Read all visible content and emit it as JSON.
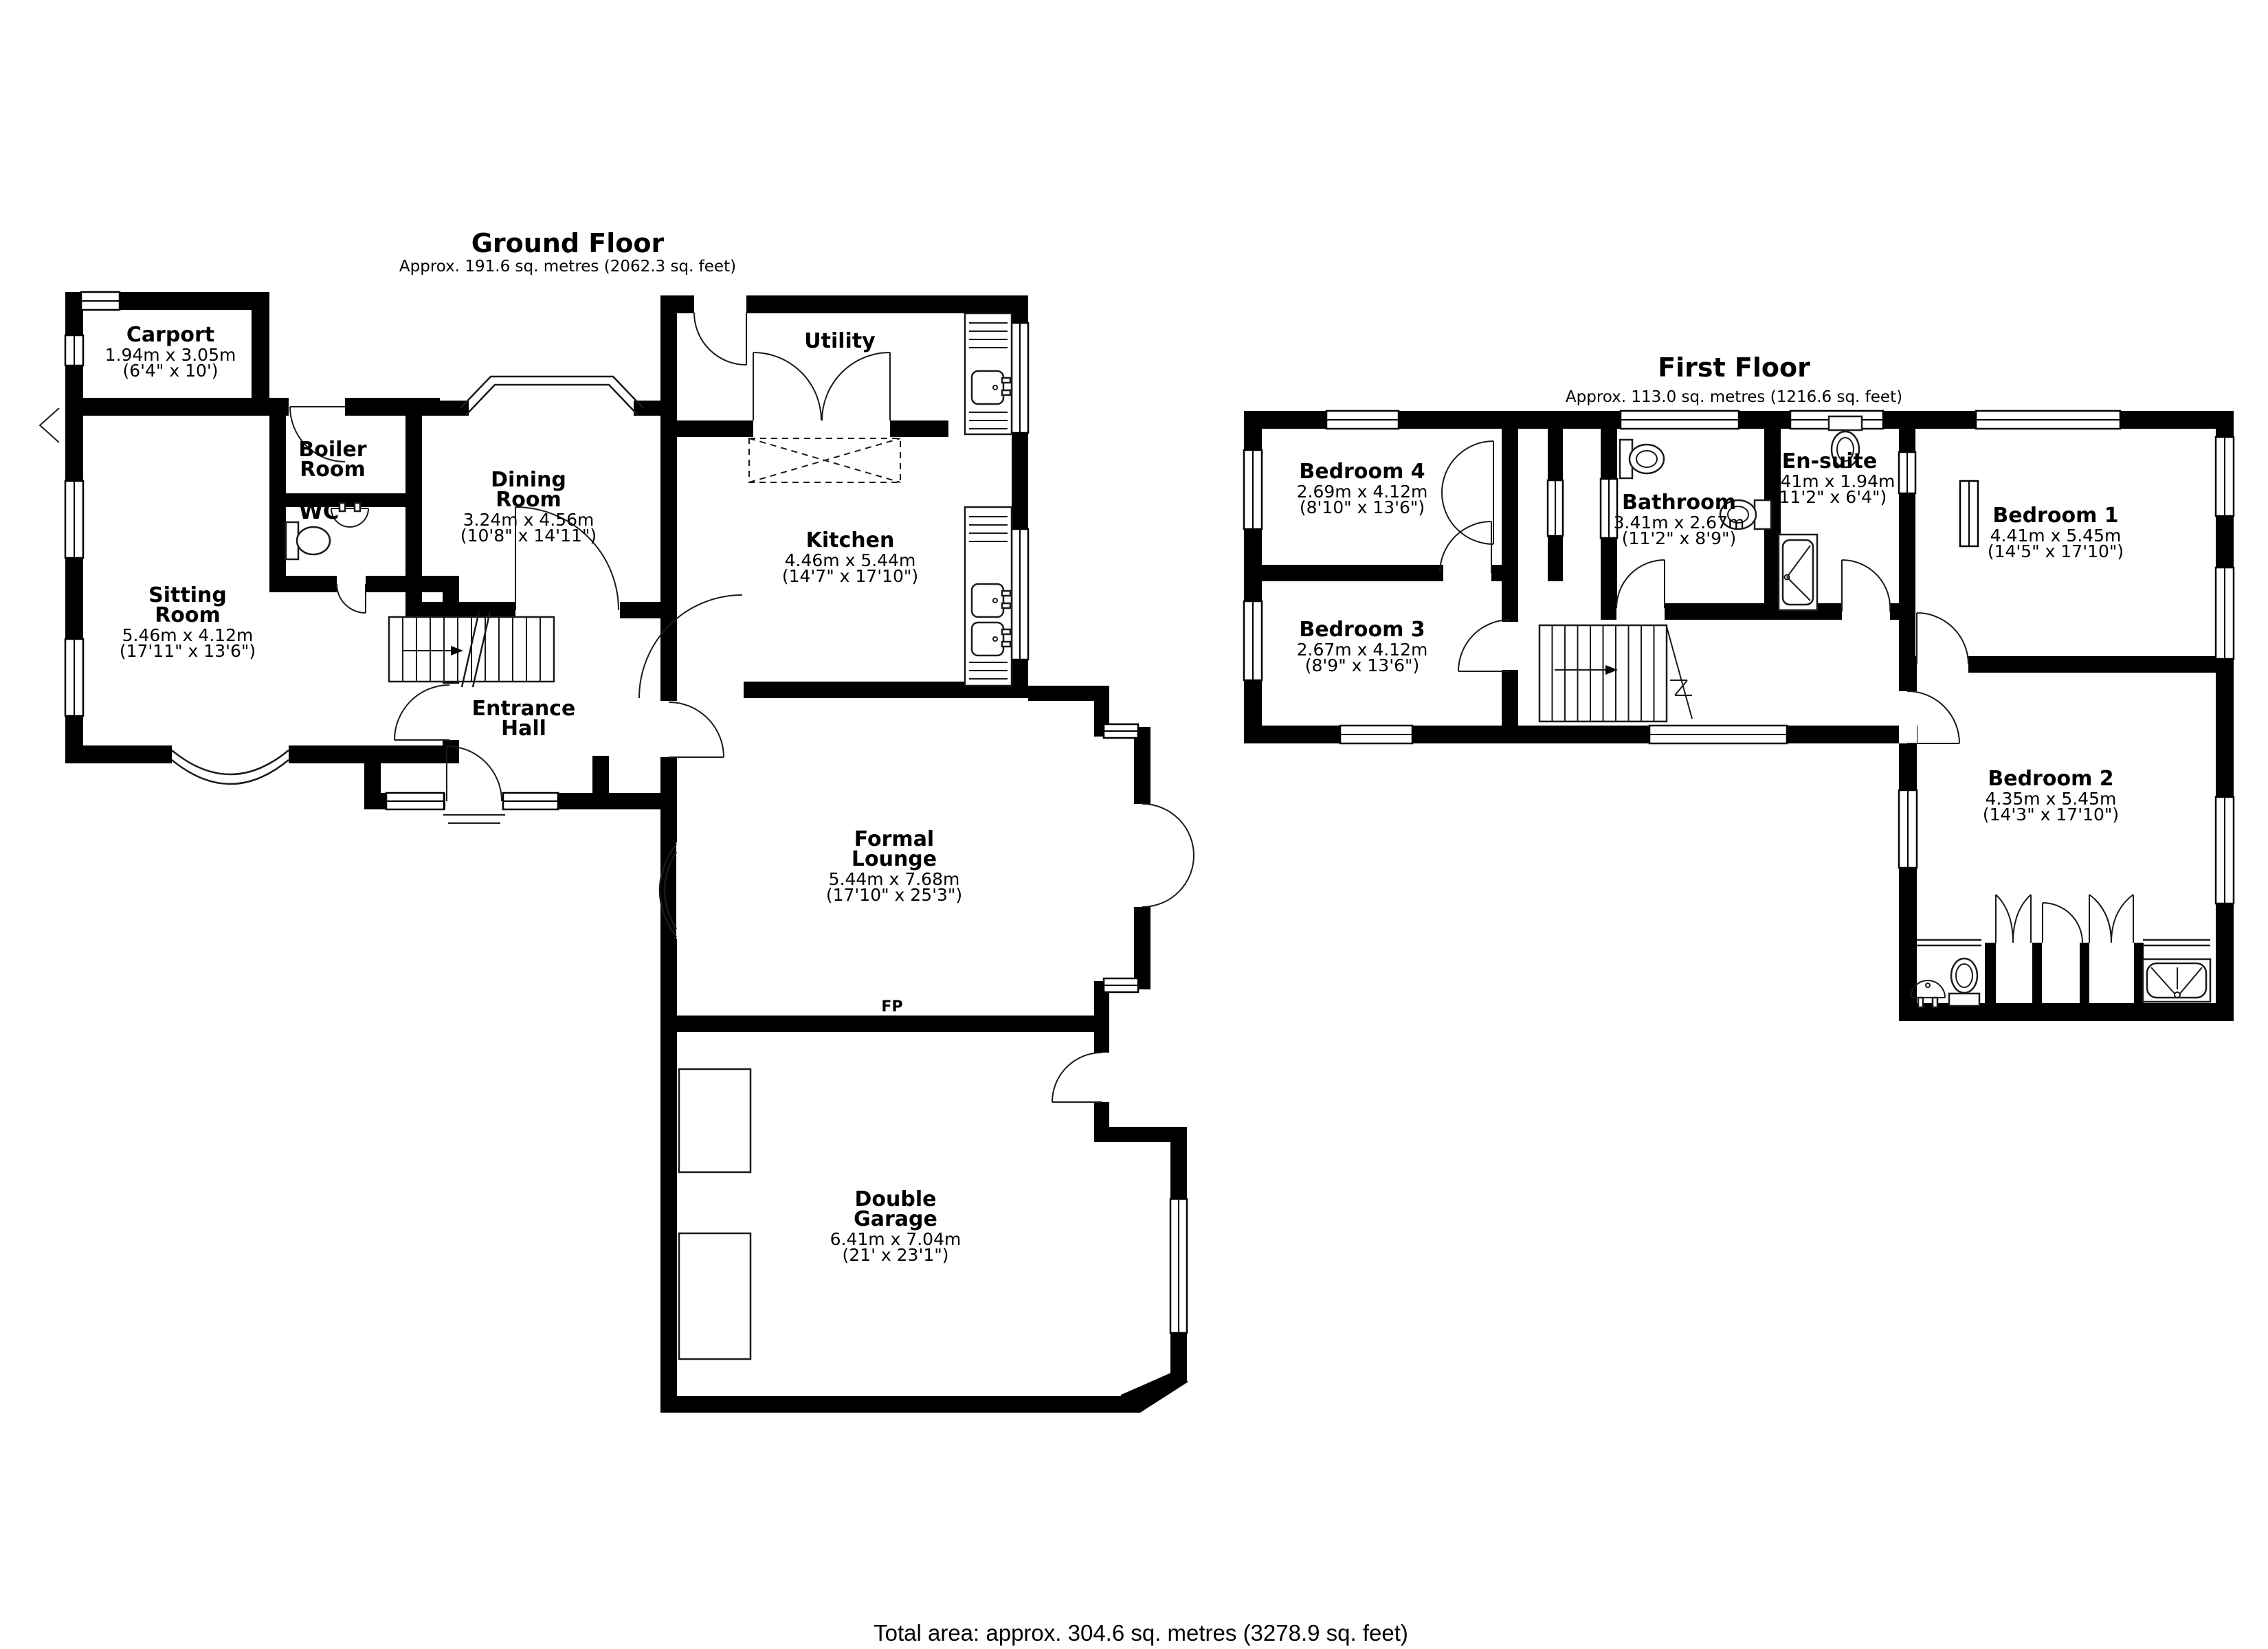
{
  "ground_floor": {
    "title": "Ground Floor",
    "subtitle": "Approx. 191.6 sq. metres (2062.3 sq. feet)",
    "rooms": [
      {
        "id": "carport",
        "name": [
          "Carport"
        ],
        "dims": [
          "1.94m x 3.05m",
          "(6'4\" x 10')"
        ]
      },
      {
        "id": "boiler-room",
        "name": [
          "Boiler",
          "Room"
        ],
        "dims": []
      },
      {
        "id": "wc",
        "name": [
          "WC"
        ],
        "dims": []
      },
      {
        "id": "dining-room",
        "name": [
          "Dining",
          "Room"
        ],
        "dims": [
          "3.24m x 4.56m",
          "(10'8\" x 14'11\")"
        ]
      },
      {
        "id": "sitting-room",
        "name": [
          "Sitting",
          "Room"
        ],
        "dims": [
          "5.46m x 4.12m",
          "(17'11\" x 13'6\")"
        ]
      },
      {
        "id": "utility",
        "name": [
          "Utility"
        ],
        "dims": []
      },
      {
        "id": "kitchen",
        "name": [
          "Kitchen"
        ],
        "dims": [
          "4.46m x 5.44m",
          "(14'7\" x 17'10\")"
        ]
      },
      {
        "id": "entrance-hall",
        "name": [
          "Entrance",
          "Hall"
        ],
        "dims": []
      },
      {
        "id": "formal-lounge",
        "name": [
          "Formal",
          "Lounge"
        ],
        "dims": [
          "5.44m x 7.68m",
          "(17'10\" x 25'3\")"
        ]
      },
      {
        "id": "fp",
        "name": [
          "FP"
        ],
        "dims": []
      },
      {
        "id": "double-garage",
        "name": [
          "Double",
          "Garage"
        ],
        "dims": [
          "6.41m x 7.04m",
          "(21' x 23'1\")"
        ]
      }
    ]
  },
  "first_floor": {
    "title": "First Floor",
    "subtitle": "Approx. 113.0 sq. metres (1216.6 sq. feet)",
    "rooms": [
      {
        "id": "bedroom-4",
        "name": [
          "Bedroom 4"
        ],
        "dims": [
          "2.69m x 4.12m",
          "(8'10\" x 13'6\")"
        ]
      },
      {
        "id": "bathroom",
        "name": [
          "Bathroom"
        ],
        "dims": [
          "3.41m x 2.67m",
          "(11'2\" x 8'9\")"
        ]
      },
      {
        "id": "en-suite",
        "name": [
          "En-suite"
        ],
        "dims": [
          "3.41m x 1.94m",
          "(11'2\" x 6'4\")"
        ]
      },
      {
        "id": "bedroom-1",
        "name": [
          "Bedroom 1"
        ],
        "dims": [
          "4.41m x 5.45m",
          "(14'5\" x 17'10\")"
        ]
      },
      {
        "id": "bedroom-3",
        "name": [
          "Bedroom 3"
        ],
        "dims": [
          "2.67m x 4.12m",
          "(8'9\" x 13'6\")"
        ]
      },
      {
        "id": "bedroom-2",
        "name": [
          "Bedroom 2"
        ],
        "dims": [
          "4.35m x 5.45m",
          "(14'3\" x 17'10\")"
        ]
      }
    ]
  },
  "footer": {
    "total_area": "Total area: approx. 304.6 sq. metres (3278.9 sq. feet)"
  }
}
